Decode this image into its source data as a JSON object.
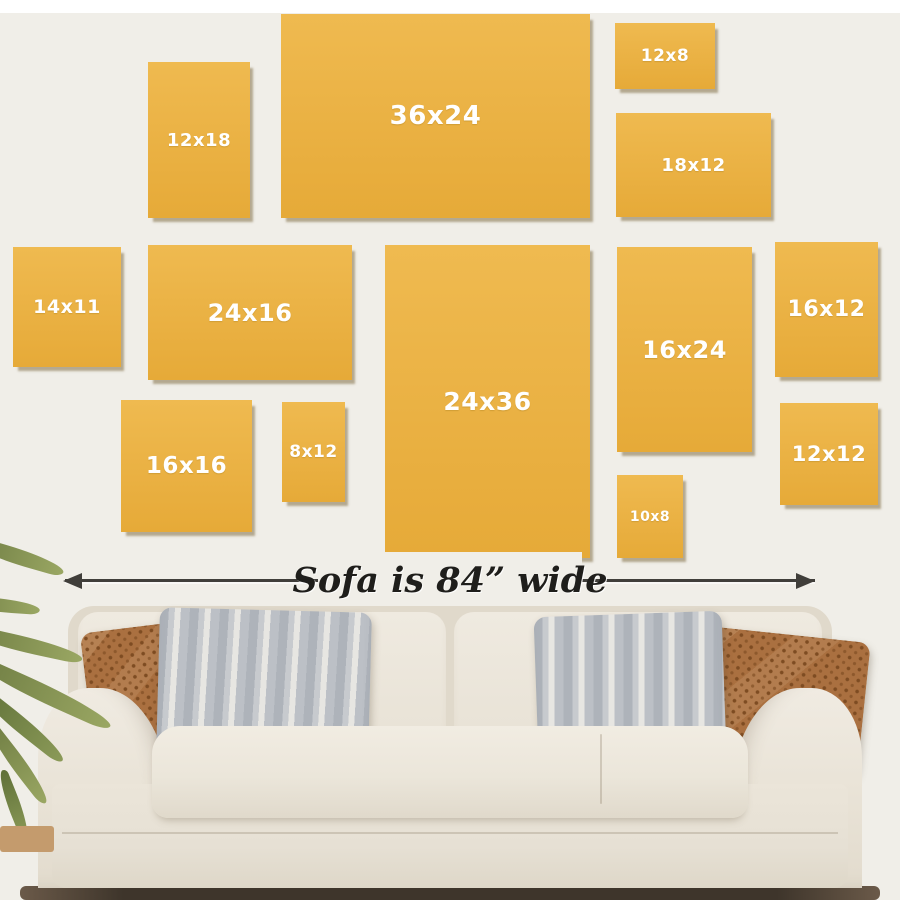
{
  "panels": [
    {
      "label": "12x18",
      "x": 148,
      "y": 62,
      "w": 102,
      "h": 156,
      "font_px": 18
    },
    {
      "label": "36x24",
      "x": 281,
      "y": 14,
      "w": 309,
      "h": 204,
      "font_px": 26
    },
    {
      "label": "12x8",
      "x": 615,
      "y": 23,
      "w": 100,
      "h": 66,
      "font_px": 17
    },
    {
      "label": "18x12",
      "x": 616,
      "y": 113,
      "w": 155,
      "h": 104,
      "font_px": 18
    },
    {
      "label": "14x11",
      "x": 13,
      "y": 247,
      "w": 108,
      "h": 120,
      "font_px": 19
    },
    {
      "label": "24x16",
      "x": 148,
      "y": 245,
      "w": 204,
      "h": 135,
      "font_px": 24
    },
    {
      "label": "24x36",
      "x": 385,
      "y": 245,
      "w": 205,
      "h": 313,
      "font_px": 25
    },
    {
      "label": "16x24",
      "x": 617,
      "y": 247,
      "w": 135,
      "h": 205,
      "font_px": 24
    },
    {
      "label": "16x12",
      "x": 775,
      "y": 242,
      "w": 103,
      "h": 135,
      "font_px": 22
    },
    {
      "label": "16x16",
      "x": 121,
      "y": 400,
      "w": 131,
      "h": 132,
      "font_px": 23
    },
    {
      "label": "8x12",
      "x": 282,
      "y": 402,
      "w": 63,
      "h": 100,
      "font_px": 17
    },
    {
      "label": "12x12",
      "x": 780,
      "y": 403,
      "w": 98,
      "h": 102,
      "font_px": 21
    },
    {
      "label": "10x8",
      "x": 617,
      "y": 475,
      "w": 66,
      "h": 83,
      "font_px": 14
    }
  ],
  "annotation": {
    "label": "Sofa is 84” wide"
  },
  "colors": {
    "wall": "#f0eee8",
    "top_strip": "#ffffff",
    "panel": "#eab143",
    "panel_hi": "#efba50",
    "panel_lo": "#e6aa38",
    "panel_text": "#ffffff",
    "panel_shadow": "rgba(120,100,55,0.5)",
    "arrow": "#403e3a",
    "sofa_dark": "#e0d9cb",
    "pillow_rust": "#aa7040",
    "pillow_rust_dark": "#7e4c22",
    "pillow_gray": "#aeb3ba",
    "pillow_gray_light": "#e7e6e2",
    "plant_green": "#9aa763",
    "plant_green_dark": "#6f7d43",
    "floor_dark": "#3e352b",
    "floor_tan": "#c49b6d"
  }
}
